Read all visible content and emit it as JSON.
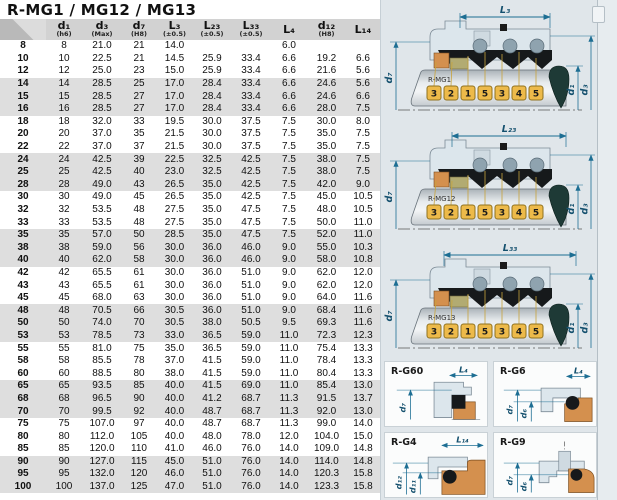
{
  "title": "R-MG1 / MG12 / MG13",
  "table": {
    "columns": [
      {
        "label": "",
        "tol": ""
      },
      {
        "label": "d₁",
        "tol": "(h6)"
      },
      {
        "label": "d₃",
        "tol": "(Max)"
      },
      {
        "label": "d₇",
        "tol": "(H8)"
      },
      {
        "label": "L₃",
        "tol": "(±0.5)"
      },
      {
        "label": "L₂₃",
        "tol": "(±0.5)"
      },
      {
        "label": "L₃₃",
        "tol": "(±0.5)"
      },
      {
        "label": "L₄",
        "tol": ""
      },
      {
        "label": "d₁₂",
        "tol": "(H8)"
      },
      {
        "label": "L₁₄",
        "tol": ""
      }
    ],
    "rows": [
      [
        "8",
        "8",
        "21.0",
        "21",
        "14.0",
        "",
        "",
        "6.0",
        "",
        ""
      ],
      [
        "10",
        "10",
        "22.5",
        "21",
        "14.5",
        "25.9",
        "33.4",
        "6.6",
        "19.2",
        "6.6"
      ],
      [
        "12",
        "12",
        "25.0",
        "23",
        "15.0",
        "25.9",
        "33.4",
        "6.6",
        "21.6",
        "5.6"
      ],
      [
        "14",
        "14",
        "28.5",
        "25",
        "17.0",
        "28.4",
        "33.4",
        "6.6",
        "24.6",
        "5.6"
      ],
      [
        "15",
        "15",
        "28.5",
        "27",
        "17.0",
        "28.4",
        "33.4",
        "6.6",
        "24.6",
        "6.6"
      ],
      [
        "16",
        "16",
        "28.5",
        "27",
        "17.0",
        "28.4",
        "33.4",
        "6.6",
        "28.0",
        "7.5"
      ],
      [
        "18",
        "18",
        "32.0",
        "33",
        "19.5",
        "30.0",
        "37.5",
        "7.5",
        "30.0",
        "8.0"
      ],
      [
        "20",
        "20",
        "37.0",
        "35",
        "21.5",
        "30.0",
        "37.5",
        "7.5",
        "35.0",
        "7.5"
      ],
      [
        "22",
        "22",
        "37.0",
        "37",
        "21.5",
        "30.0",
        "37.5",
        "7.5",
        "35.0",
        "7.5"
      ],
      [
        "24",
        "24",
        "42.5",
        "39",
        "22.5",
        "32.5",
        "42.5",
        "7.5",
        "38.0",
        "7.5"
      ],
      [
        "25",
        "25",
        "42.5",
        "40",
        "23.0",
        "32.5",
        "42.5",
        "7.5",
        "38.0",
        "7.5"
      ],
      [
        "28",
        "28",
        "49.0",
        "43",
        "26.5",
        "35.0",
        "42.5",
        "7.5",
        "42.0",
        "9.0"
      ],
      [
        "30",
        "30",
        "49.0",
        "45",
        "26.5",
        "35.0",
        "42.5",
        "7.5",
        "45.0",
        "10.5"
      ],
      [
        "32",
        "32",
        "53.5",
        "48",
        "27.5",
        "35.0",
        "47.5",
        "7.5",
        "48.0",
        "10.5"
      ],
      [
        "33",
        "33",
        "53.5",
        "48",
        "27.5",
        "35.0",
        "47.5",
        "7.5",
        "50.0",
        "11.0"
      ],
      [
        "35",
        "35",
        "57.0",
        "50",
        "28.5",
        "35.0",
        "47.5",
        "7.5",
        "52.0",
        "11.0"
      ],
      [
        "38",
        "38",
        "59.0",
        "56",
        "30.0",
        "36.0",
        "46.0",
        "9.0",
        "55.0",
        "10.3"
      ],
      [
        "40",
        "40",
        "62.0",
        "58",
        "30.0",
        "36.0",
        "46.0",
        "9.0",
        "58.0",
        "10.8"
      ],
      [
        "42",
        "42",
        "65.5",
        "61",
        "30.0",
        "36.0",
        "51.0",
        "9.0",
        "62.0",
        "12.0"
      ],
      [
        "43",
        "43",
        "65.5",
        "61",
        "30.0",
        "36.0",
        "51.0",
        "9.0",
        "62.0",
        "12.0"
      ],
      [
        "45",
        "45",
        "68.0",
        "63",
        "30.0",
        "36.0",
        "51.0",
        "9.0",
        "64.0",
        "11.6"
      ],
      [
        "48",
        "48",
        "70.5",
        "66",
        "30.5",
        "36.0",
        "51.0",
        "9.0",
        "68.4",
        "11.6"
      ],
      [
        "50",
        "50",
        "74.0",
        "70",
        "30.5",
        "38.0",
        "50.5",
        "9.5",
        "69.3",
        "11.6"
      ],
      [
        "53",
        "53",
        "78.5",
        "73",
        "33.0",
        "36.5",
        "59.0",
        "11.0",
        "72.3",
        "12.3"
      ],
      [
        "55",
        "55",
        "81.0",
        "75",
        "35.0",
        "36.5",
        "59.0",
        "11.0",
        "75.4",
        "13.3"
      ],
      [
        "58",
        "58",
        "85.5",
        "78",
        "37.0",
        "41.5",
        "59.0",
        "11.0",
        "78.4",
        "13.3"
      ],
      [
        "60",
        "60",
        "88.5",
        "80",
        "38.0",
        "41.5",
        "59.0",
        "11.0",
        "80.4",
        "13.3"
      ],
      [
        "65",
        "65",
        "93.5",
        "85",
        "40.0",
        "41.5",
        "69.0",
        "11.0",
        "85.4",
        "13.0"
      ],
      [
        "68",
        "68",
        "96.5",
        "90",
        "40.0",
        "41.2",
        "68.7",
        "11.3",
        "91.5",
        "13.7"
      ],
      [
        "70",
        "70",
        "99.5",
        "92",
        "40.0",
        "48.7",
        "68.7",
        "11.3",
        "92.0",
        "13.0"
      ],
      [
        "75",
        "75",
        "107.0",
        "97",
        "40.0",
        "48.7",
        "68.7",
        "11.3",
        "99.0",
        "14.0"
      ],
      [
        "80",
        "80",
        "112.0",
        "105",
        "40.0",
        "48.0",
        "78.0",
        "12.0",
        "104.0",
        "15.0"
      ],
      [
        "85",
        "85",
        "120.0",
        "110",
        "41.0",
        "46.0",
        "76.0",
        "14.0",
        "109.0",
        "14.8"
      ],
      [
        "90",
        "90",
        "127.0",
        "115",
        "45.0",
        "51.0",
        "76.0",
        "14.0",
        "114.0",
        "14.8"
      ],
      [
        "95",
        "95",
        "132.0",
        "120",
        "46.0",
        "51.0",
        "76.0",
        "14.0",
        "120.3",
        "15.8"
      ],
      [
        "100",
        "100",
        "137.0",
        "125",
        "47.0",
        "51.0",
        "76.0",
        "14.0",
        "123.3",
        "15.8"
      ]
    ]
  },
  "diagrams": [
    {
      "name": "R-MG1",
      "top_dim": "L₃",
      "left_dim": "d₇",
      "right_dim_inner": "d₁",
      "right_dim_outer": "d₃",
      "tags": [
        "3",
        "2",
        "1",
        "5",
        "3",
        "4",
        "5"
      ]
    },
    {
      "name": "R-MG12",
      "top_dim": "L₂₃",
      "left_dim": "d₇",
      "right_dim_inner": "d₁",
      "right_dim_outer": "d₃",
      "tags": [
        "3",
        "2",
        "1",
        "5",
        "3",
        "4",
        "5"
      ]
    },
    {
      "name": "R-MG13",
      "top_dim": "L₃₃",
      "left_dim": "d₇",
      "right_dim_inner": "d₁",
      "right_dim_outer": "d₃",
      "tags": [
        "3",
        "2",
        "1",
        "5",
        "3",
        "4",
        "5"
      ]
    }
  ],
  "cards": [
    {
      "title": "R-G60",
      "top_dim": "L₄",
      "left_dim_1": "d₇",
      "left_dim_2": ""
    },
    {
      "title": "R-G6",
      "top_dim": "L₄",
      "left_dim_1": "d₇",
      "left_dim_2": "d₆"
    },
    {
      "title": "R-G4",
      "top_dim": "L₁₄",
      "left_dim_1": "d₁₂",
      "left_dim_2": "d₁₁"
    },
    {
      "title": "R-G9",
      "top_dim": "",
      "left_dim_1": "d₇",
      "left_dim_2": "d₆"
    }
  ],
  "colors": {
    "dimension_blue": "#1d6e93",
    "tag_gold": "#edba4a",
    "seal_orange": "#d4904e",
    "seal_olive": "#b2ab72",
    "housing_gray_blue": "#dce6ec",
    "cone_dark_teal": "#1e3a36",
    "row_band_gray": "#dedede",
    "header_gray": "#d2d2d2",
    "panel_background": "#e0e6ea"
  }
}
